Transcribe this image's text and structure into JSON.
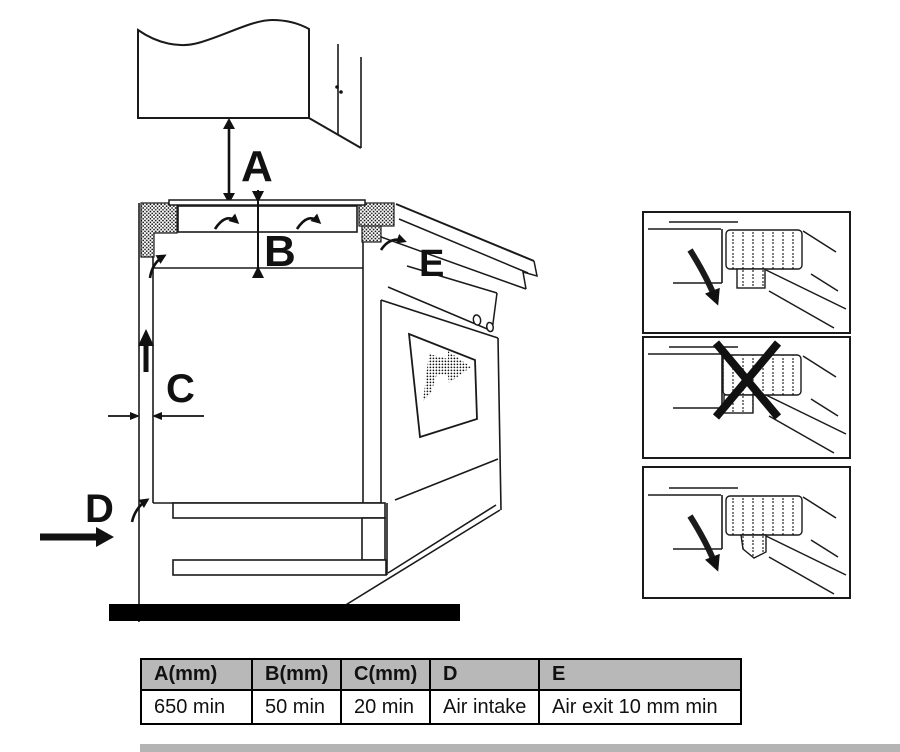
{
  "figure": {
    "labels": {
      "a": "A",
      "b": "B",
      "c": "C",
      "d": "D",
      "e": "E"
    }
  },
  "table": {
    "headers": [
      "A(mm)",
      "B(mm)",
      "C(mm)",
      "D",
      "E"
    ],
    "values": [
      "650 min",
      "50 min",
      "20 min",
      "Air intake",
      "Air exit 10 mm min"
    ]
  },
  "colors": {
    "line": "#1a1a1a",
    "table_header_bg": "#b8b8b8",
    "table_border": "#000000",
    "bottom_strip": "#b4b4b4"
  }
}
